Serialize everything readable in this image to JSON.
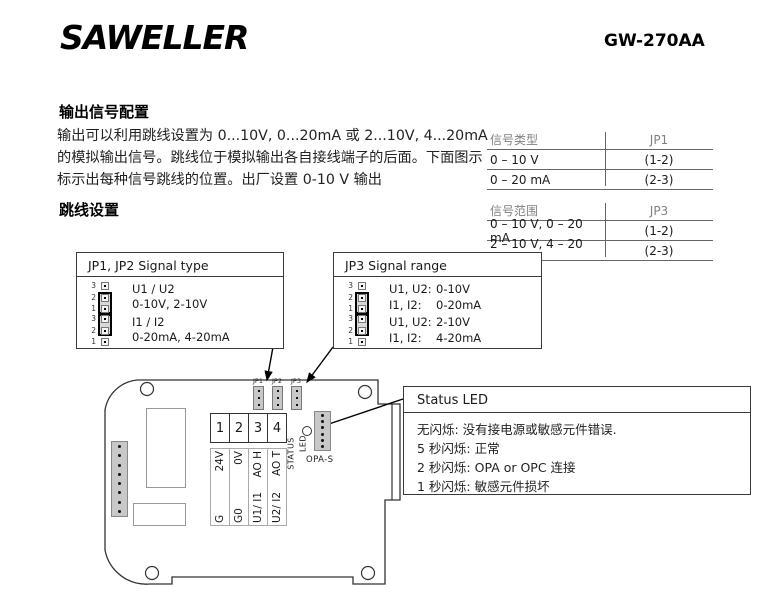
{
  "header": {
    "logo": "SAWELLER",
    "model": "GW-270AA"
  },
  "intro": {
    "title": "输出信号配置",
    "line1": "输出可以利用跳线设置为 0...10V, 0...20mA 或 2...10V, 4...20mA",
    "line2": "的模拟输出信号。跳线位于模拟输出各自接线端子的后面。下面图示",
    "line3": "标示出每种信号跳线的位置。出厂设置 0-10 V 输出",
    "subtitle": "跳线设置"
  },
  "signal_type_table": {
    "header_left": "信号类型",
    "header_right": "JP1",
    "rows": [
      {
        "label": "0 – 10 V",
        "value": "(1-2)"
      },
      {
        "label": "0 – 20 mA",
        "value": "(2-3)"
      }
    ]
  },
  "signal_range_table": {
    "header_left": "信号范围",
    "header_right": "JP3",
    "rows": [
      {
        "label": "0 – 10 V, 0 – 20 mA",
        "value": "(1-2)"
      },
      {
        "label": "2 – 10 V, 4 – 20 mA",
        "value": "(2-3)"
      }
    ]
  },
  "jp12_box": {
    "title": "JP1, JP2 Signal type",
    "pin_numbers": [
      "3",
      "2",
      "1"
    ],
    "options": [
      {
        "cap": "1-2",
        "line1": "U1 / U2",
        "line2": "0-10V, 2-10V"
      },
      {
        "cap": "2-3",
        "line1": "I1 / I2",
        "line2": "0-20mA, 4-20mA"
      }
    ]
  },
  "jp3_box": {
    "title": "JP3 Signal range",
    "pin_numbers": [
      "3",
      "2",
      "1"
    ],
    "options": [
      {
        "cap": "1-2",
        "row1_label": "U1, U2:",
        "row1_value": "0-10V",
        "row2_label": "I1, I2:",
        "row2_value": "0-20mA"
      },
      {
        "cap": "2-3",
        "row1_label": "U1, U2:",
        "row1_value": "2-10V",
        "row2_label": "I1, I2:",
        "row2_value": "4-20mA"
      }
    ]
  },
  "status_box": {
    "title": "Status LED",
    "lines": [
      "无闪烁: 没有接电源或敏感元件错误.",
      "5 秒闪烁: 正常",
      "2 秒闪烁: OPA or OPC 连接",
      "1 秒闪烁: 敏感元件损坏"
    ]
  },
  "pcb": {
    "terminal_numbers": [
      "1",
      "2",
      "3",
      "4"
    ],
    "terminal_labels": [
      {
        "bottom": "G",
        "top": "24V"
      },
      {
        "bottom": "G0",
        "top": "0V"
      },
      {
        "bottom": "U1/ I1",
        "top": "AO H"
      },
      {
        "bottom": "U2/ I2",
        "top": "AO T"
      }
    ],
    "jumper_labels": [
      "JP1",
      "JP2",
      "JP3"
    ],
    "status_led_label_line1": "STATUS",
    "status_led_label_line2": "LED",
    "opa_label": "OPA-S"
  },
  "colors": {
    "connector_gray": "#c8c8c8",
    "table_header_gray": "#808080"
  }
}
